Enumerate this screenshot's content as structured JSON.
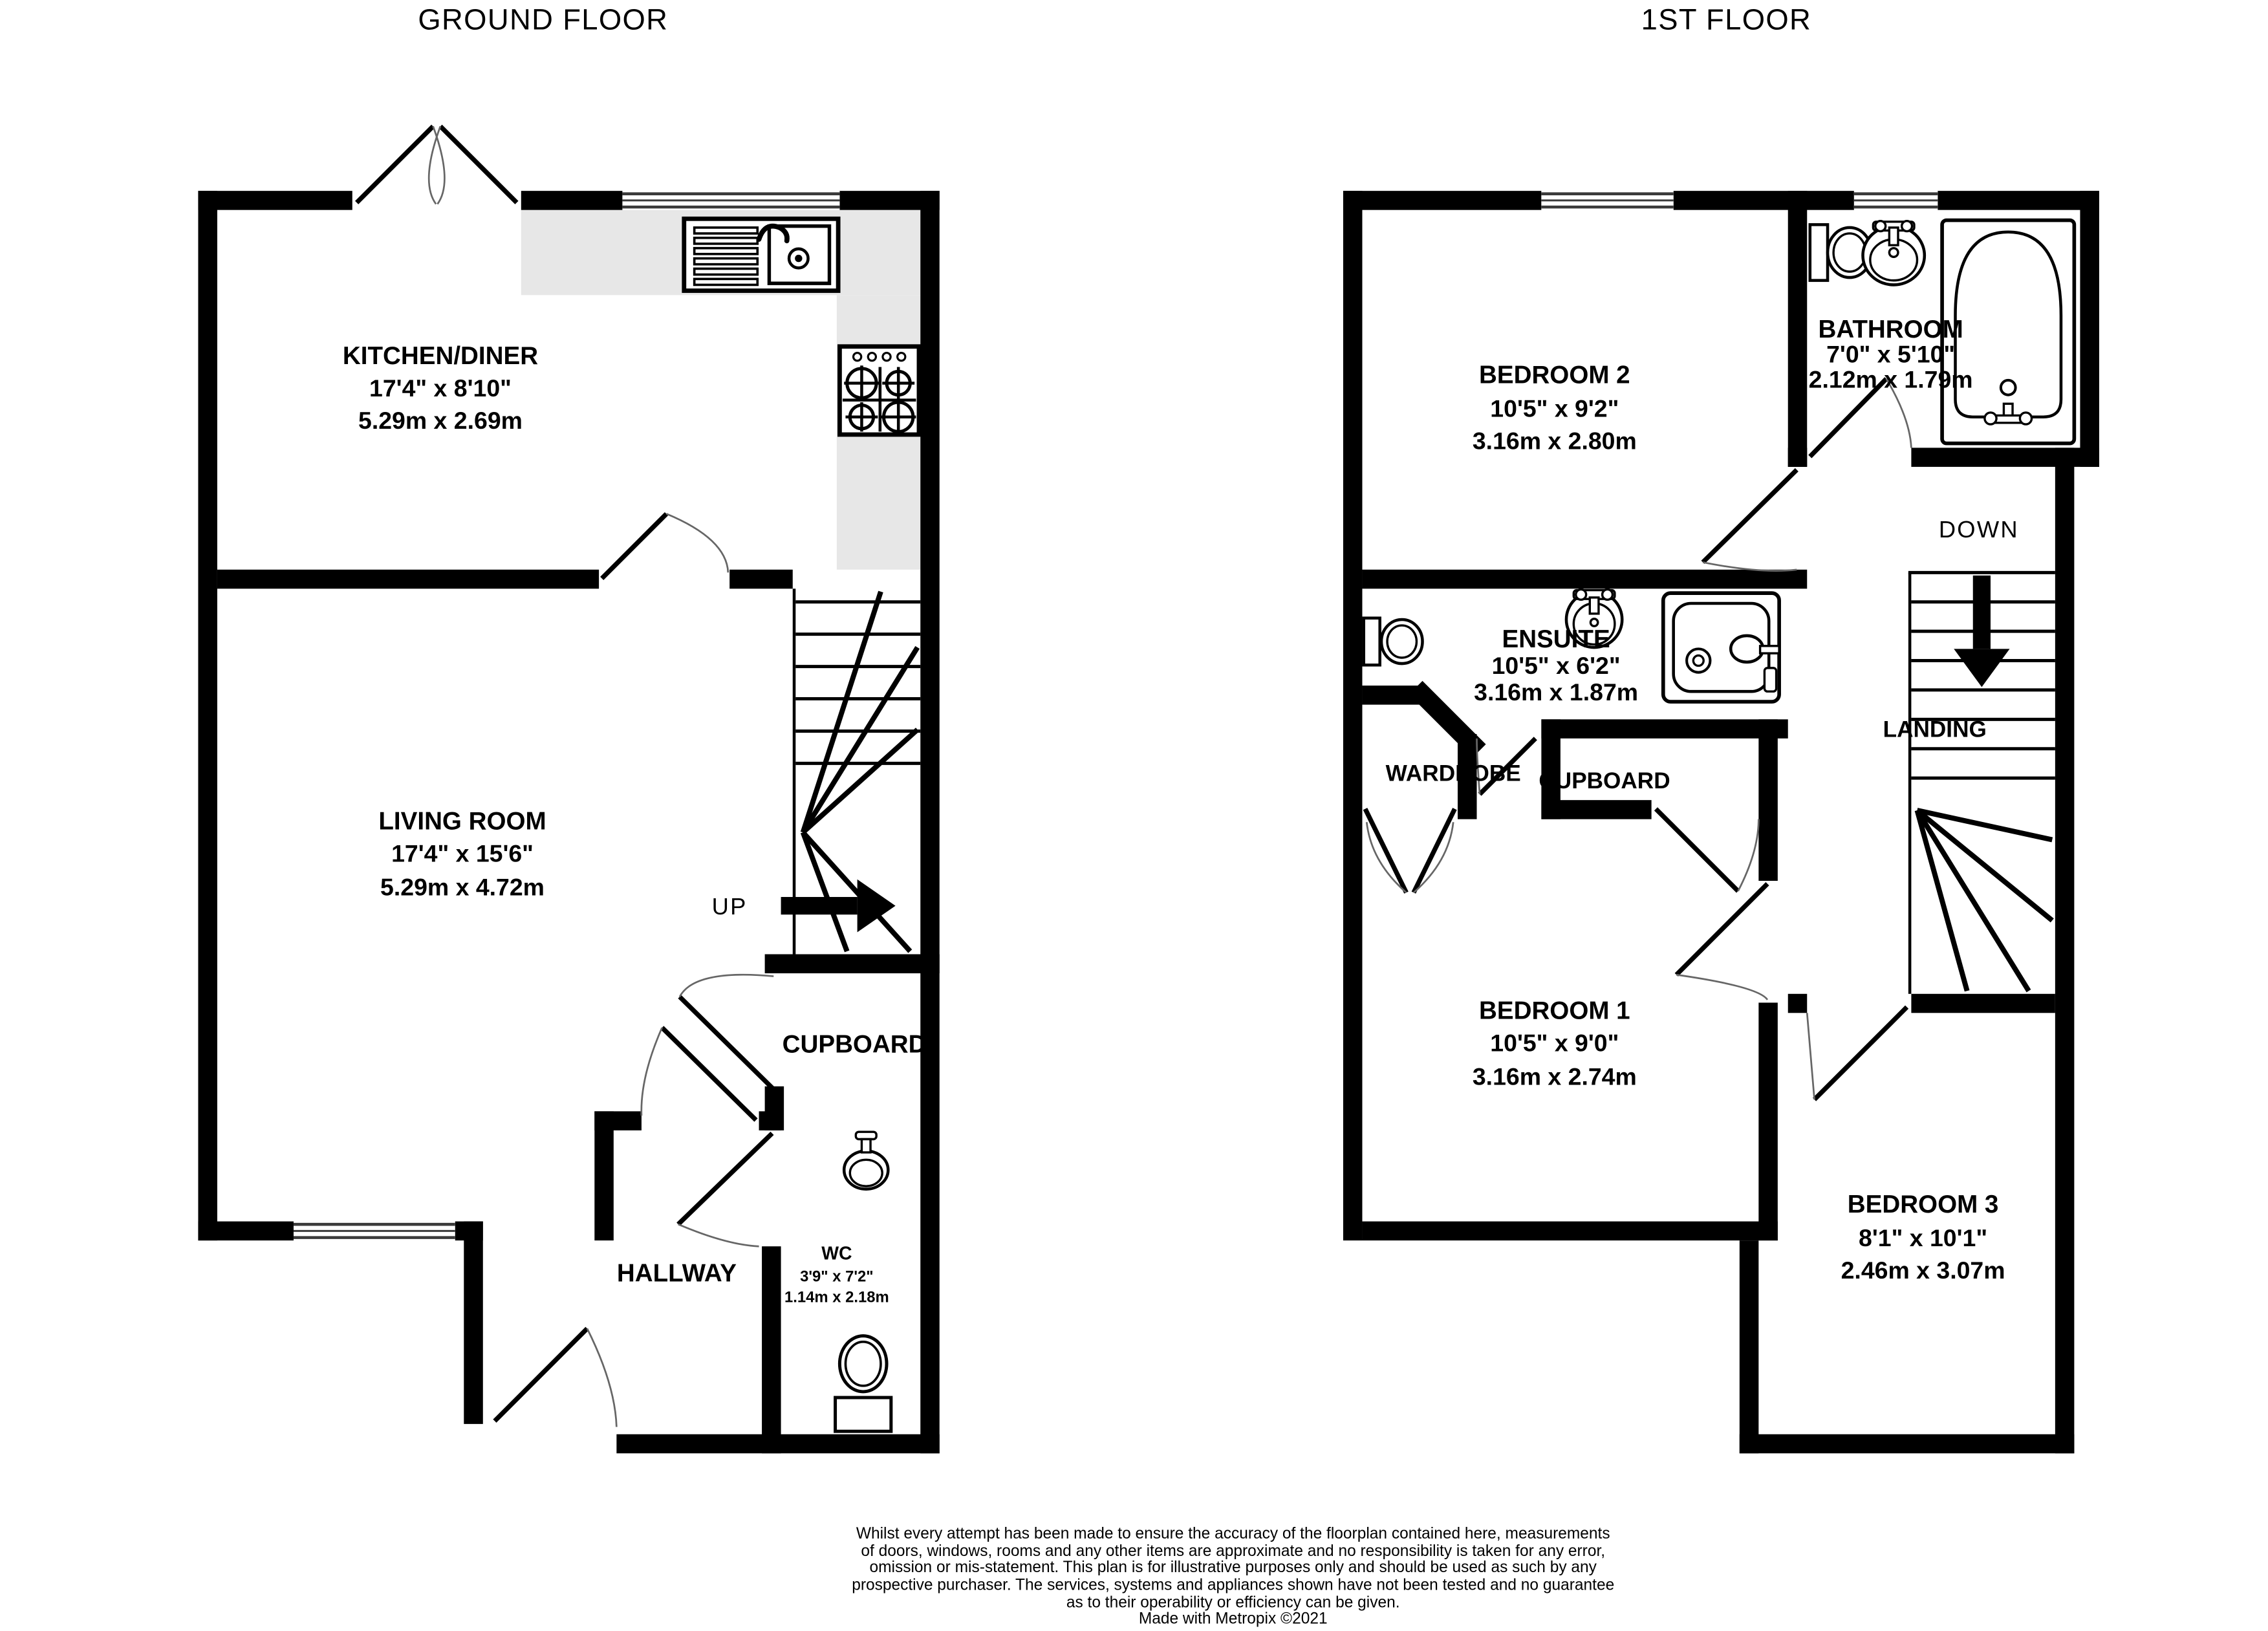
{
  "titles": {
    "ground_floor": "GROUND FLOOR",
    "first_floor": "1ST FLOOR"
  },
  "rooms": {
    "kitchen_diner": {
      "name": "KITCHEN/DINER",
      "imperial": "17'4\"  x 8'10\"",
      "metric": "5.29m  x 2.69m"
    },
    "living_room": {
      "name": "LIVING ROOM",
      "imperial": "17'4\"  x 15'6\"",
      "metric": "5.29m  x 4.72m"
    },
    "cupboard_ground": {
      "name": "CUPBOARD"
    },
    "hallway": {
      "name": "HALLWAY"
    },
    "wc": {
      "name": "WC",
      "imperial": "3'9\"  x 7'2\"",
      "metric": "1.14m  x 2.18m"
    },
    "bedroom_2": {
      "name": "BEDROOM 2",
      "imperial": "10'5\"  x 9'2\"",
      "metric": "3.16m  x 2.80m"
    },
    "bathroom": {
      "name": "BATHROOM",
      "imperial": "7'0\"  x 5'10\"",
      "metric": "2.12m  x 1.79m"
    },
    "ensuite": {
      "name": "ENSUITE",
      "imperial": "10'5\"  x 6'2\"",
      "metric": "3.16m  x 1.87m"
    },
    "wardrobe": {
      "name": "WARDROBE"
    },
    "cupboard_first": {
      "name": "CUPBOARD"
    },
    "landing": {
      "name": "LANDING"
    },
    "bedroom_1": {
      "name": "BEDROOM 1",
      "imperial": "10'5\"  x 9'0\"",
      "metric": "3.16m  x 2.74m"
    },
    "bedroom_3": {
      "name": "BEDROOM 3",
      "imperial": "8'1\"  x 10'1\"",
      "metric": "2.46m  x 3.07m"
    }
  },
  "stairs": {
    "up_label": "UP",
    "down_label": "DOWN"
  },
  "disclaimer": [
    "Whilst every attempt has been made to ensure the accuracy of the floorplan contained here, measurements",
    "of doors, windows, rooms and any other items are approximate and no responsibility is taken for any error,",
    "omission or mis-statement. This plan is for illustrative purposes only and should be used as such by any",
    "prospective purchaser. The services, systems and appliances shown have not been tested and no guarantee",
    "as to their operability or efficiency can be given."
  ],
  "credit": "Made with Metropix ©2021",
  "colors": {
    "wall": "#000000",
    "counter": "#e7e7e7",
    "background": "#ffffff"
  }
}
